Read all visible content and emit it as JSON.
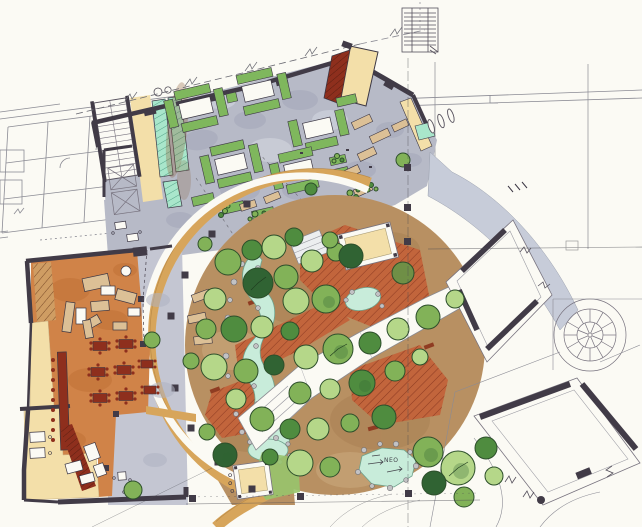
{
  "canvas": {
    "width": 642,
    "height": 527
  },
  "annotations": {
    "pond_label": "NEO"
  },
  "palette": {
    "paper": "#fbfaf4",
    "ink": "#3c3744",
    "line": "#8b8b94",
    "wall": "#413b47",
    "plaza": "#b7bac7",
    "plaza_shadow": "#a2a6b8",
    "walk": "#c4c6d2",
    "ramp": "#c7ccd9",
    "ring": "#d7a55b",
    "ground": "#b89062",
    "ground_shadow": "#9c7347",
    "deck": "#c2653c",
    "deck_dark": "#8f3c22",
    "floor": "#d08348",
    "floor_shadow": "#bb6b31",
    "cream": "#f3dfa9",
    "mint": "#a9e6cb",
    "mint_stripe": "#53a287",
    "water": "#c8ecda",
    "water_edge": "#6fa38d",
    "rock": "#c2c2c4",
    "tree_light": "#b5d789",
    "tree_mid": "#82b258",
    "tree_dark": "#4f8c3f",
    "tree_deep": "#306333",
    "tree_olive": "#6f8f46",
    "lawn": "#98c46d",
    "table_red": "#8e2f1d",
    "tan": "#dcc096",
    "furniture_green": "#7fb75d",
    "brown_wash": "#8a5a33"
  }
}
